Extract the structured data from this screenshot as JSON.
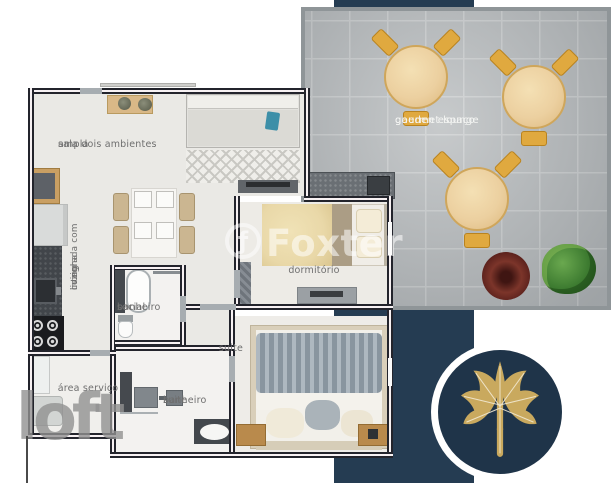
{
  "colors": {
    "navy": "#253c52",
    "navy_dark": "#1f3449",
    "gold": "#c9a95e",
    "wall": "#23242c",
    "tile": "#b2b6b8",
    "label": "#6f6f6f",
    "wood": "#e0a93f",
    "teal": "#3d8fa8",
    "blanket": "#93a0ab",
    "firepit": "#5b211c",
    "plant": "#3e7c31"
  },
  "floorplan": {
    "labels": {
      "living_line1": "ampla",
      "living_line2": "sala dois ambientes",
      "kitchen_line1": "cozinha",
      "kitchen_line2": "integrada com",
      "kitchen_line3": "living",
      "bath_social_line1": "banheiro",
      "bath_social_line2": "social",
      "laundry": "área serviço",
      "bedroom": "dormitório",
      "suite": "suite",
      "bath_suite_line1": "banheiro",
      "bath_suite_line2": "suite"
    }
  },
  "garden": {
    "label_line1": "gaeden espaço",
    "label_line2": "gourmet lounge"
  },
  "watermarks": {
    "brand": "Foxter",
    "brand_initial": "ƒ",
    "portal": "loft"
  }
}
